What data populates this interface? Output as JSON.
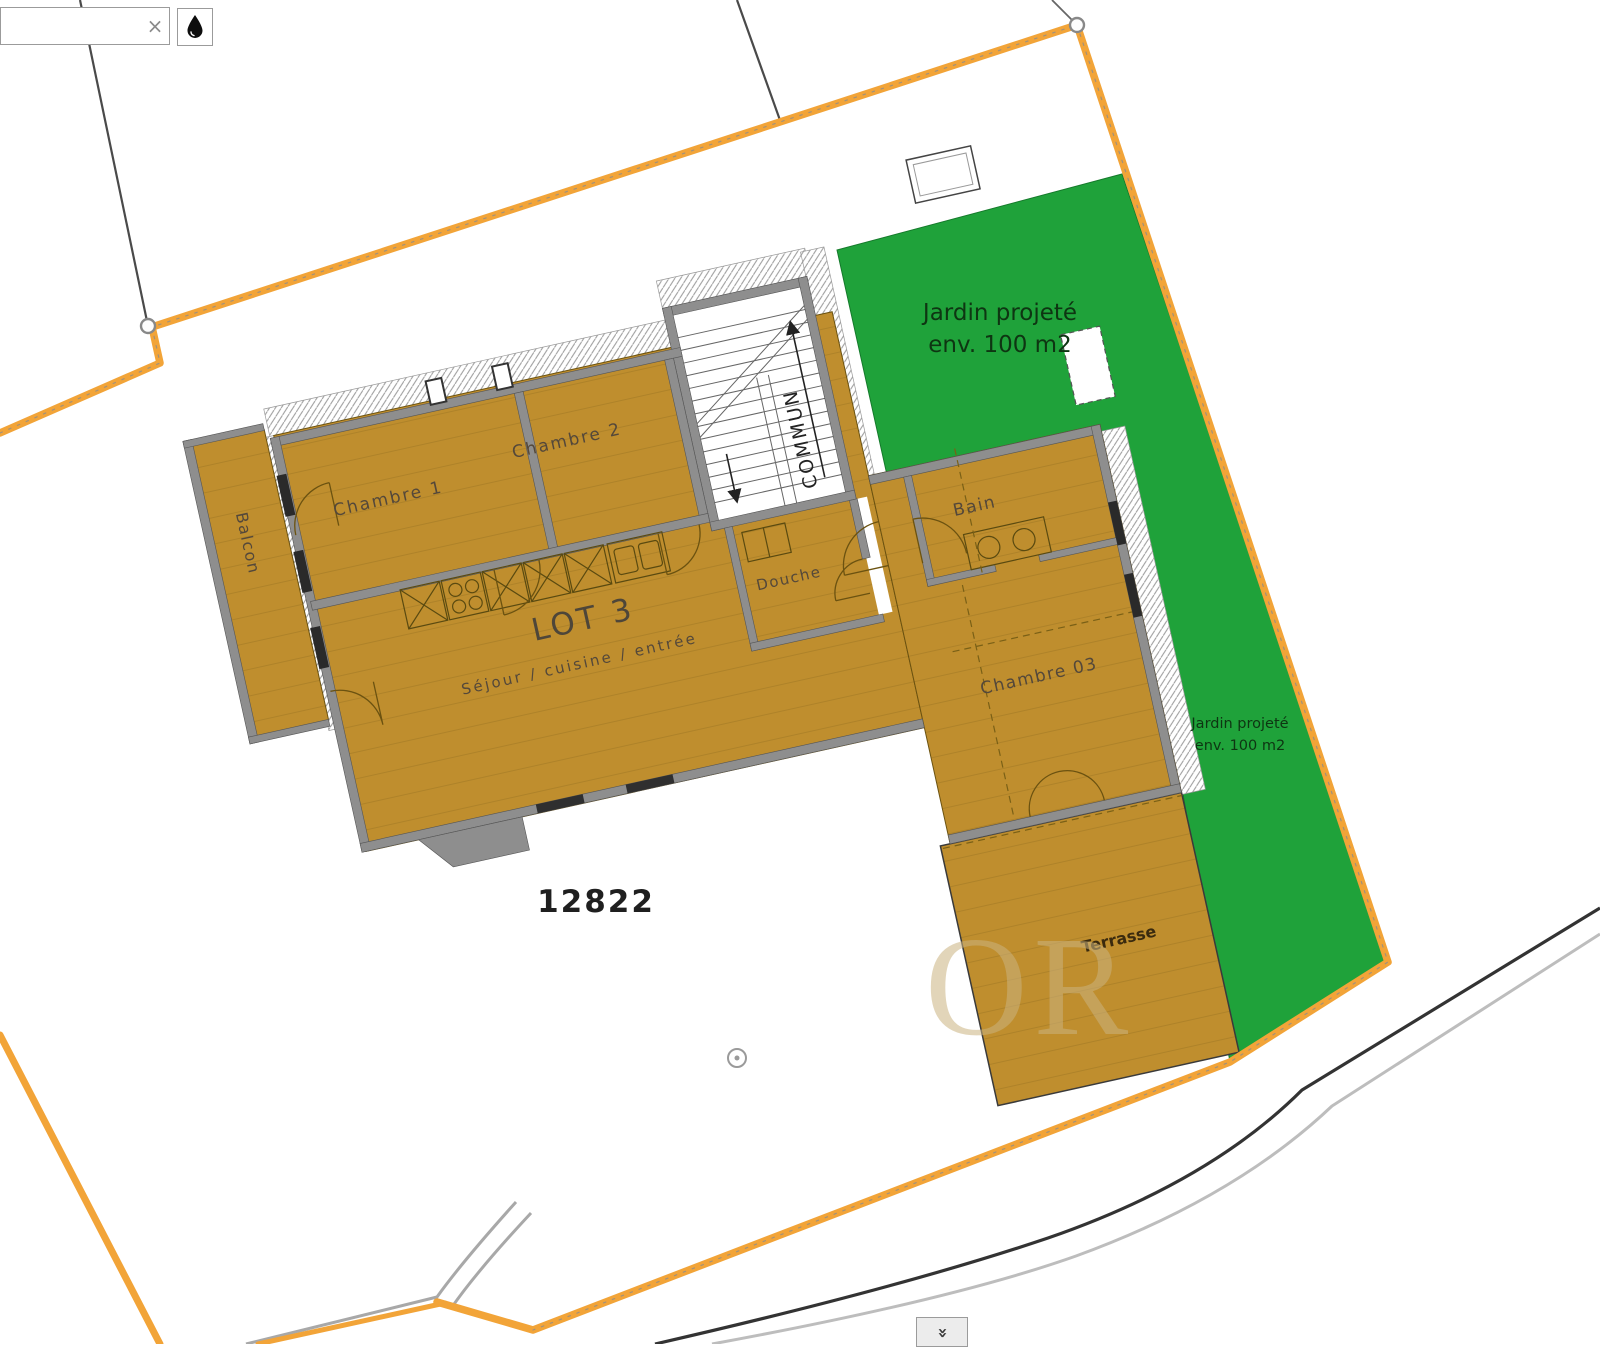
{
  "ui": {
    "search": {
      "value": "",
      "placeholder": "",
      "clear_icon": "×"
    },
    "droplet_button": {
      "icon": "droplet-icon"
    },
    "collapse_button": {
      "icon": "double-chevron-down-icon",
      "glyph": "»"
    }
  },
  "plan": {
    "lot_label": "LOT 3",
    "parcel_number": "12822",
    "rooms": {
      "chambre1": "Chambre 1",
      "chambre2": "Chambre 2",
      "sejour": "Séjour  /  cuisine  /  entrée",
      "douche": "Douche",
      "bain": "Bain",
      "chambre03": "Chambre 03",
      "terrasse": "Terrasse",
      "balcon": "Balcon",
      "commun": "COMMUN"
    },
    "garden_large": {
      "line1": "Jardin projeté",
      "line2": "env. 100 m2"
    },
    "garden_small": {
      "line1": "Jardin projeté",
      "line2": "env. 100 m2"
    }
  },
  "watermark": "OR",
  "colors": {
    "parcel_boundary": "#f2a438",
    "garden_green": "#1fa23a",
    "floor_ochre": "#bf8e2e",
    "wall_gray": "#8e8e8e",
    "road_dark": "#333333",
    "road_light": "#bdbdbd",
    "text_dark": "#54483a",
    "green_text": "#0e3512"
  }
}
